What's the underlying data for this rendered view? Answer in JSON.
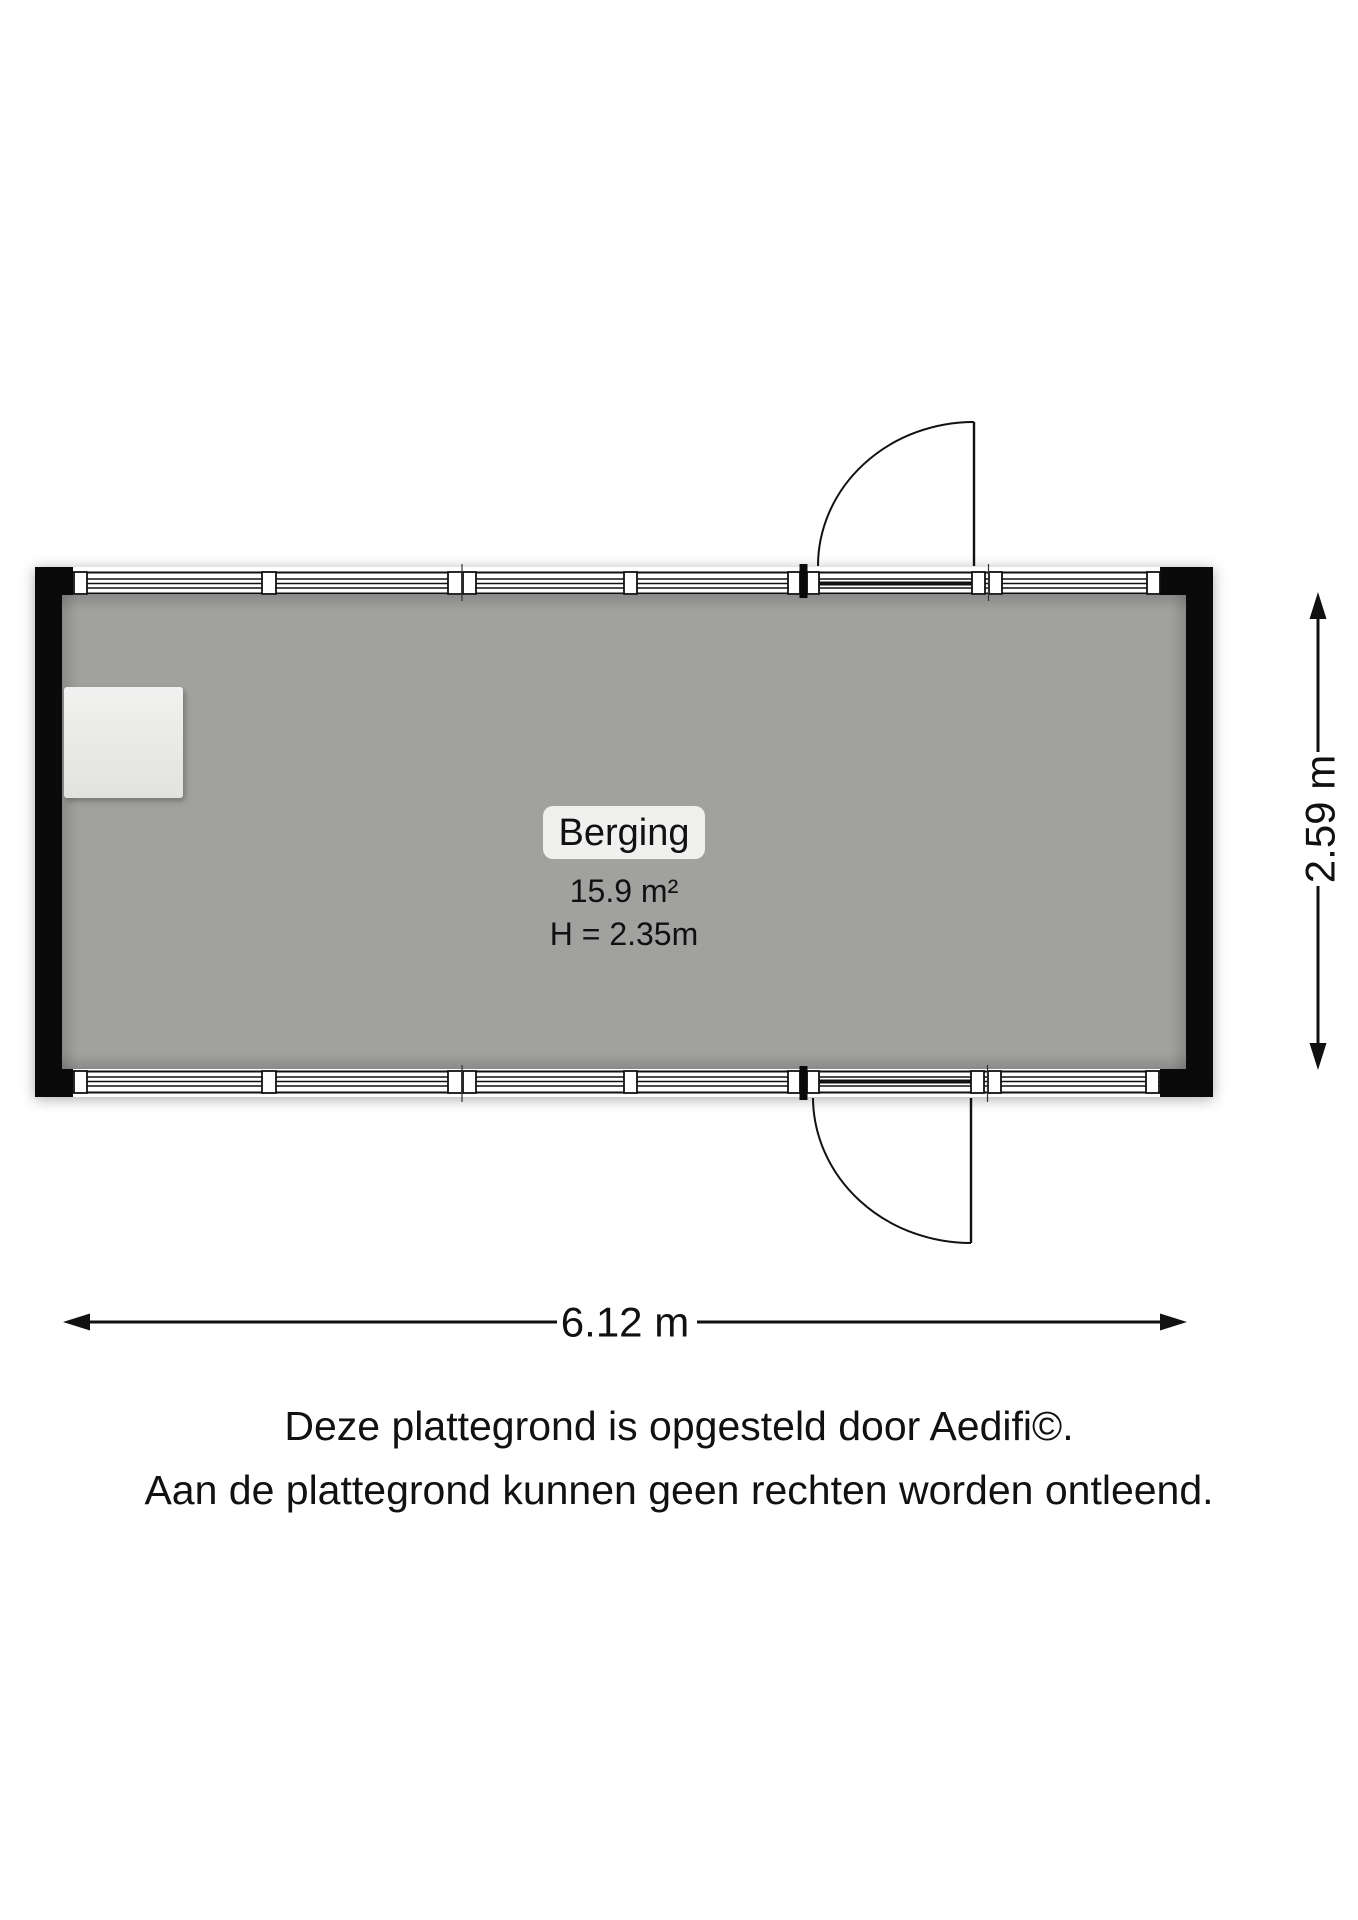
{
  "plan": {
    "room": {
      "name": "Berging",
      "area": "15.9 m²",
      "ceiling_height": "H = 2.35m"
    },
    "dimensions": {
      "width_label": "6.12 m",
      "height_label": "2.59 m"
    },
    "footer": {
      "line1": "Deze plattegrond is opgesteld door Aedifi©.",
      "line2": "Aan de plattegrond kunnen geen rechten worden ontleend."
    },
    "colors": {
      "background": "#ffffff",
      "floor": "#a1a19f",
      "wall": "#0a0a0a",
      "window_band": "#ffffff",
      "label_bg": "#f0f1ee",
      "fixture": "#e9e9e7",
      "text": "#111111"
    }
  }
}
